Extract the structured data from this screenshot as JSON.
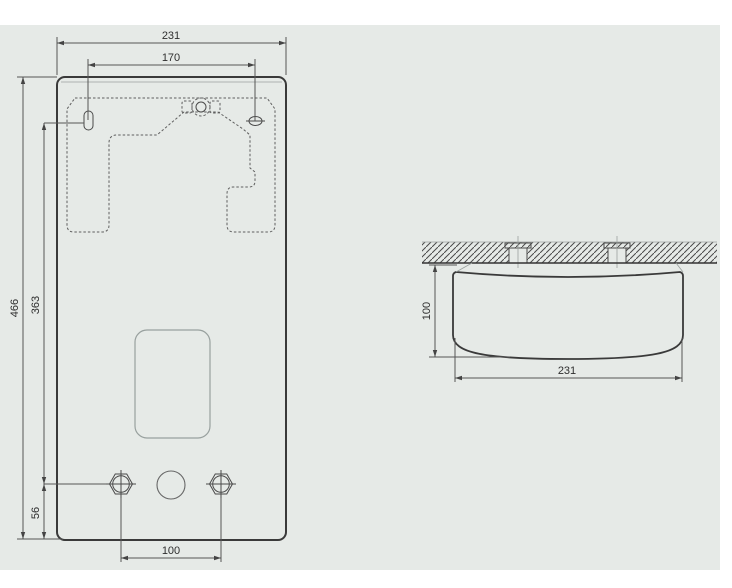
{
  "colors": {
    "panel_background": "#e6eae7",
    "outline": "#3a3a3a",
    "dimension_line": "#555555",
    "hatch_line": "#4a4a4a",
    "text": "#2e2e2e"
  },
  "front_view": {
    "overall_width": "231",
    "bracket_hole_spacing": "170",
    "overall_height": "466",
    "bracket_to_connections": "363",
    "connections_to_bottom": "56",
    "connection_spacing": "100"
  },
  "side_view": {
    "depth": "100",
    "width": "231"
  }
}
